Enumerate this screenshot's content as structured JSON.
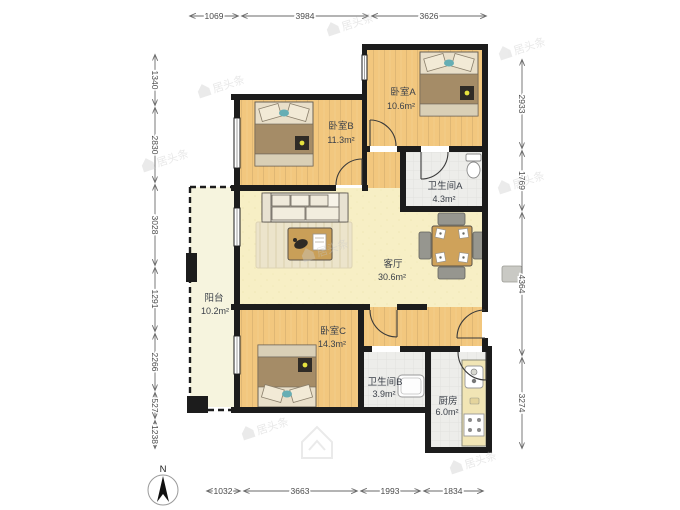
{
  "watermark": {
    "text": "居头条"
  },
  "compass": {
    "north_label": "N"
  },
  "rooms": {
    "bedroomA": {
      "name": "卧室A",
      "area": "10.6m²"
    },
    "bedroomB": {
      "name": "卧室B",
      "area": "11.3m²"
    },
    "bedroomC": {
      "name": "卧室C",
      "area": "14.3m²"
    },
    "bathA": {
      "name": "卫生间A",
      "area": "4.3m²"
    },
    "bathB": {
      "name": "卫生间B",
      "area": "3.9m²"
    },
    "living": {
      "name": "客厅",
      "area": "30.6m²"
    },
    "balcony": {
      "name": "阳台",
      "area": "10.2m²"
    },
    "kitchen": {
      "name": "厨房",
      "area": "6.0m²"
    }
  },
  "dimensions_mm": {
    "top": [
      "1069",
      "3984",
      "3626"
    ],
    "bottom": [
      "1032",
      "3663",
      "1993",
      "1834"
    ],
    "left": [
      "1340",
      "2830",
      "3028",
      "1291",
      "2266",
      "527",
      "1238"
    ],
    "right": [
      "2933",
      "1769",
      "4364",
      "3274"
    ]
  },
  "colors": {
    "wall": "#1c1c1c",
    "wood_floor": "#f2c77e",
    "living_floor": "#f7efc5",
    "tile_floor": "#ededea",
    "balcony_floor": "#f6f4de"
  }
}
